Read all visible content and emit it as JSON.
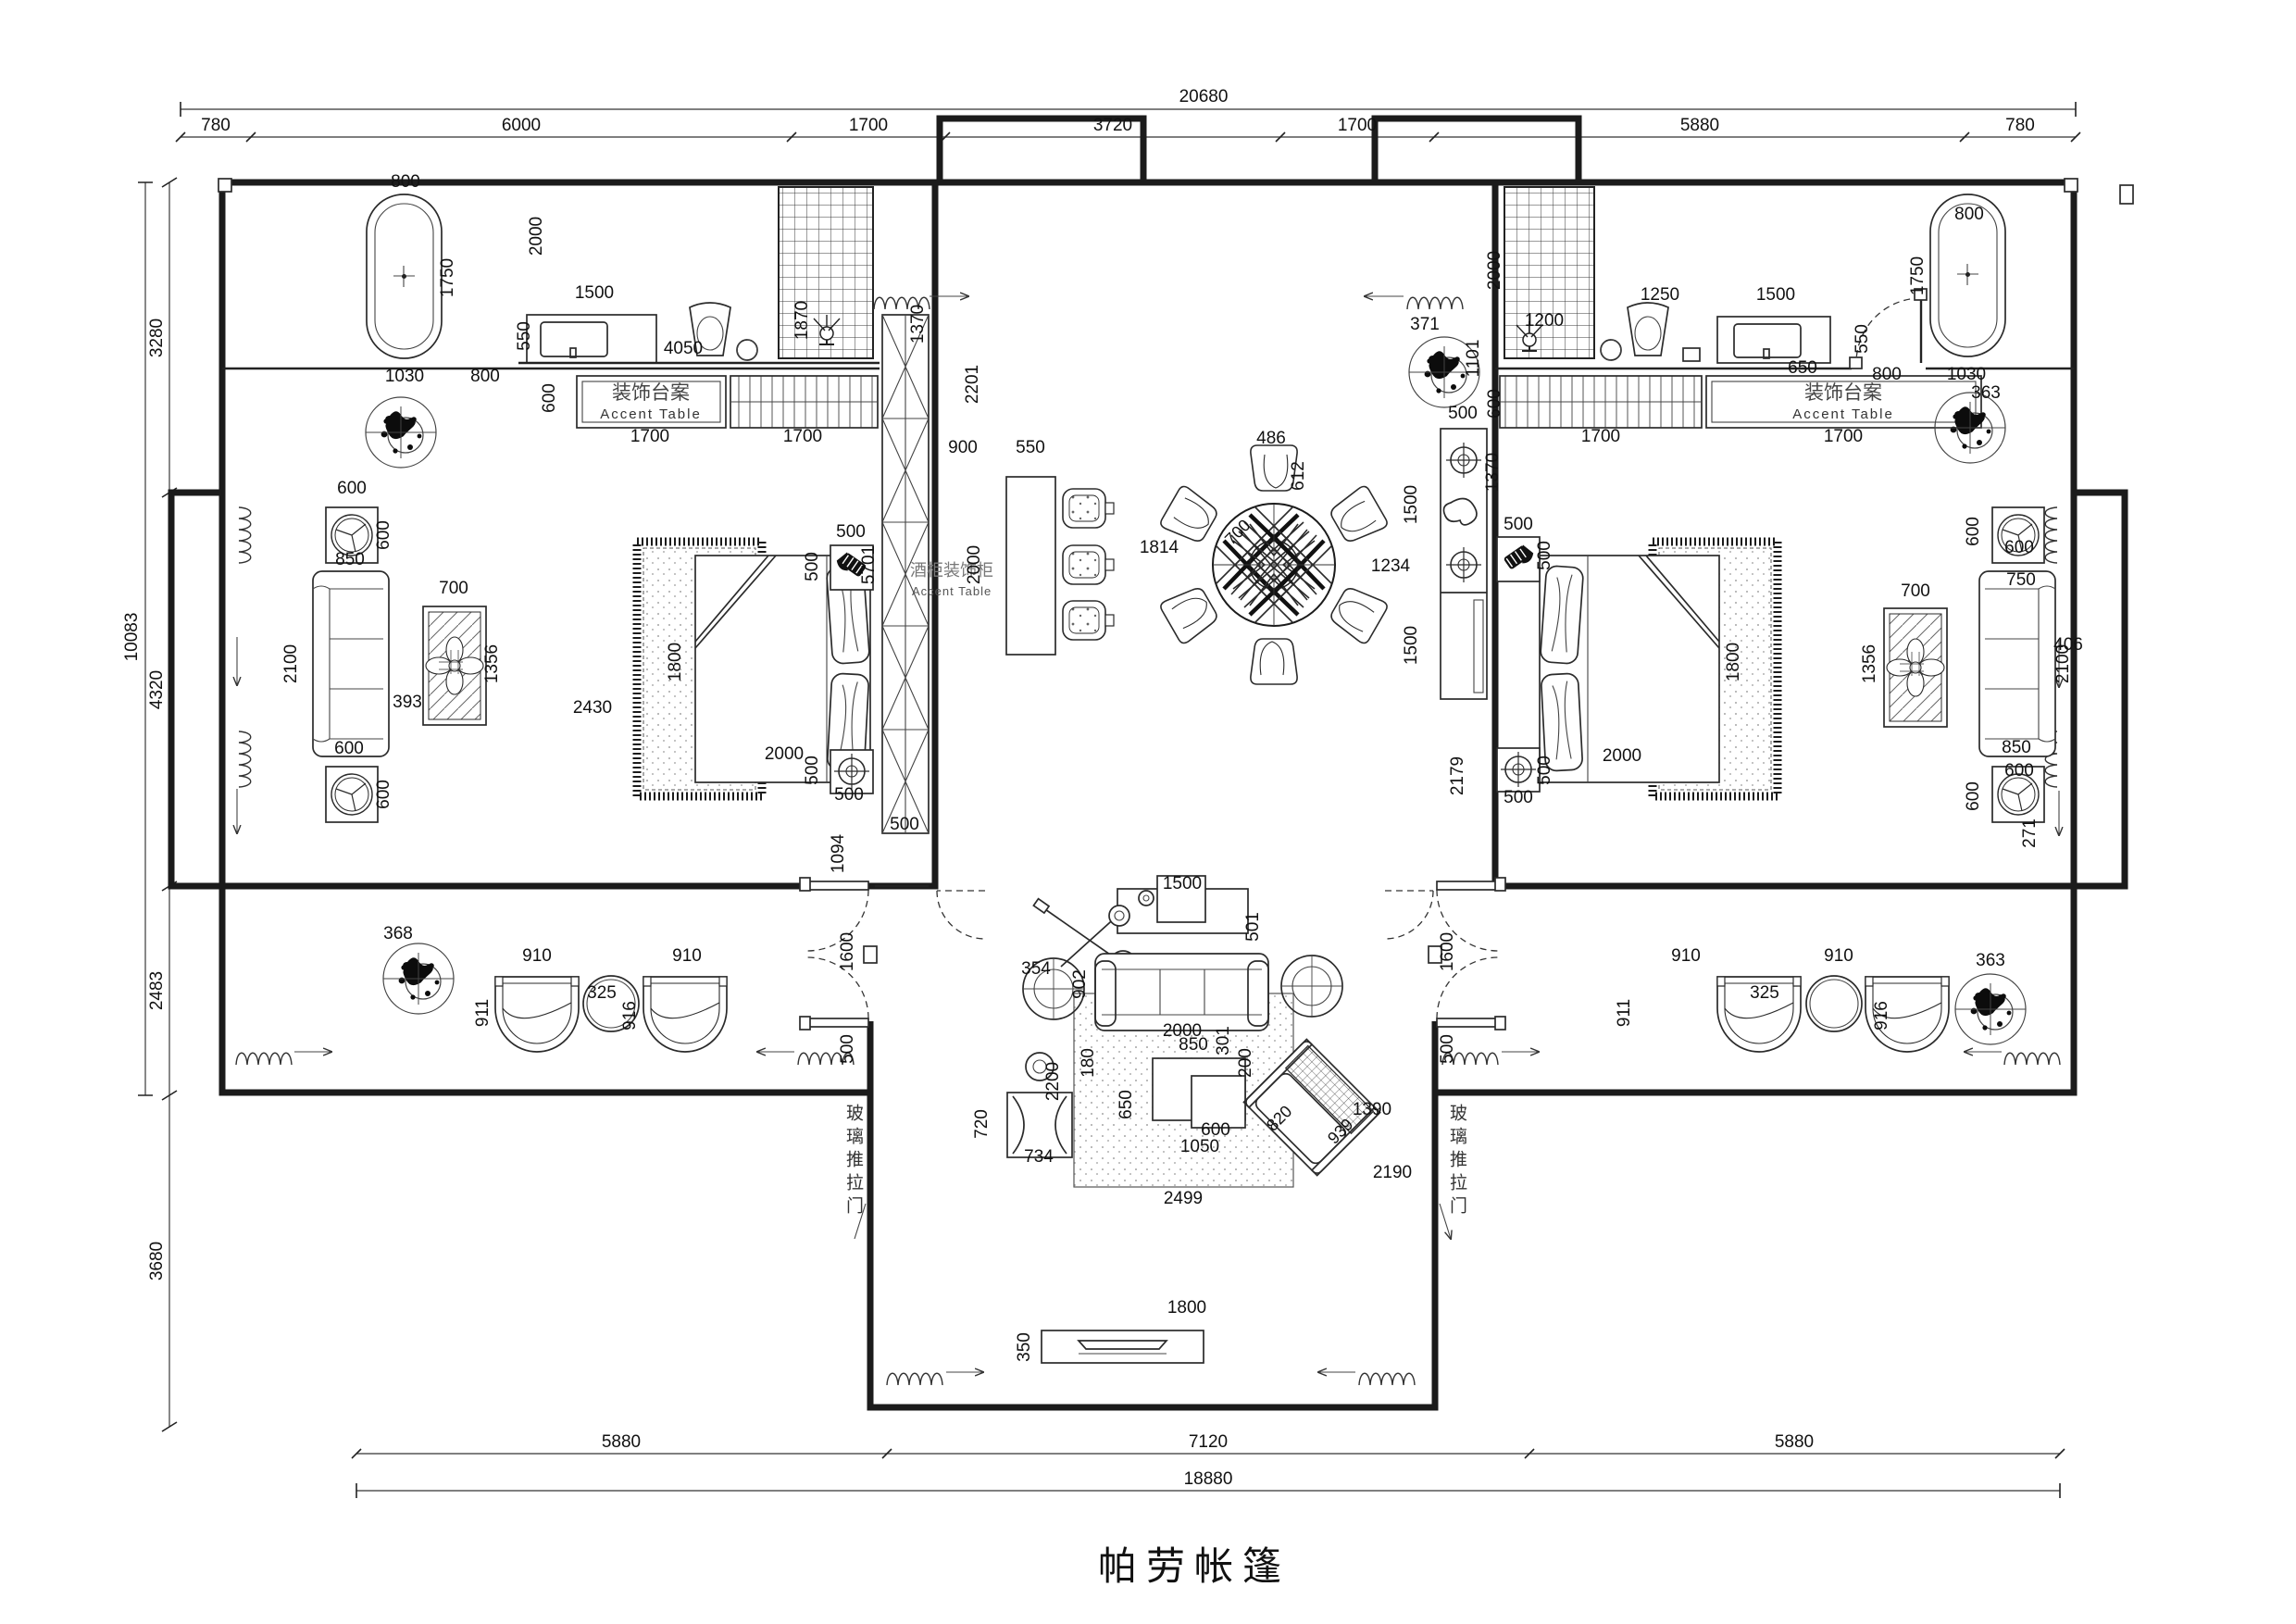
{
  "title": "帕劳帐篷",
  "labels": {
    "accent_cn": "装饰台案",
    "accent_en": "Accent Table",
    "cabinet_cn": "酒柜装饰柜",
    "cabinet_en": "Accent Table",
    "glass_door": "玻璃推拉门"
  },
  "dims": [
    [
      1300,
      110,
      "20680"
    ],
    [
      233,
      141,
      "780"
    ],
    [
      563,
      141,
      "6000"
    ],
    [
      938,
      141,
      "1700"
    ],
    [
      1202,
      141,
      "3720"
    ],
    [
      1466,
      141,
      "1700"
    ],
    [
      1836,
      141,
      "5880"
    ],
    [
      2182,
      141,
      "780"
    ],
    [
      148,
      688,
      "10083",
      -90
    ],
    [
      175,
      365,
      "3280",
      -90
    ],
    [
      175,
      745,
      "4320",
      -90
    ],
    [
      175,
      1070,
      "2483",
      -90
    ],
    [
      175,
      1362,
      "3680",
      -90
    ],
    [
      671,
      1563,
      "5880"
    ],
    [
      1305,
      1563,
      "7120"
    ],
    [
      1938,
      1563,
      "5880"
    ],
    [
      1305,
      1603,
      "18880"
    ],
    [
      438,
      202,
      "800"
    ],
    [
      489,
      300,
      "1750",
      -90
    ],
    [
      437,
      412,
      "1030"
    ],
    [
      524,
      412,
      "800"
    ],
    [
      642,
      322,
      "1500"
    ],
    [
      572,
      363,
      "550",
      -90
    ],
    [
      585,
      255,
      "2000",
      -90
    ],
    [
      738,
      382,
      "4050"
    ],
    [
      599,
      430,
      "600",
      -90
    ],
    [
      702,
      477,
      "1700"
    ],
    [
      867,
      477,
      "1700"
    ],
    [
      380,
      533,
      "600"
    ],
    [
      420,
      578,
      "600",
      -90
    ],
    [
      378,
      610,
      "850"
    ],
    [
      320,
      717,
      "2100",
      -90
    ],
    [
      377,
      814,
      "600"
    ],
    [
      420,
      858,
      "600",
      -90
    ],
    [
      490,
      641,
      "700"
    ],
    [
      537,
      717,
      "1356",
      -90
    ],
    [
      440,
      764,
      "393"
    ],
    [
      640,
      770,
      "2430"
    ],
    [
      735,
      715,
      "1800",
      -90
    ],
    [
      847,
      820,
      "2000"
    ],
    [
      919,
      580,
      "500"
    ],
    [
      883,
      612,
      "500",
      -90
    ],
    [
      917,
      864,
      "500"
    ],
    [
      883,
      832,
      "500",
      -90
    ],
    [
      911,
      922,
      "1094",
      -90
    ],
    [
      977,
      896,
      "500"
    ],
    [
      872,
      346,
      "1870",
      -90
    ],
    [
      997,
      350,
      "1370",
      -90
    ],
    [
      944,
      610,
      "5701",
      -90
    ],
    [
      1056,
      415,
      "2201",
      -90
    ],
    [
      1040,
      489,
      "900"
    ],
    [
      1113,
      489,
      "550"
    ],
    [
      1058,
      610,
      "2000",
      -90
    ],
    [
      1252,
      597,
      "1814"
    ],
    [
      1373,
      479,
      "486"
    ],
    [
      1408,
      514,
      "612",
      -90
    ],
    [
      1341,
      579,
      "700",
      -45
    ],
    [
      1502,
      617,
      "1234"
    ],
    [
      1580,
      452,
      "500"
    ],
    [
      1530,
      545,
      "1500",
      -90
    ],
    [
      1530,
      697,
      "1500",
      -90
    ],
    [
      1580,
      838,
      "2179",
      -90
    ],
    [
      1620,
      292,
      "2000",
      -90
    ],
    [
      1668,
      352,
      "1200"
    ],
    [
      1539,
      356,
      "371"
    ],
    [
      1597,
      387,
      "1101",
      -90
    ],
    [
      1793,
      324,
      "1250"
    ],
    [
      1918,
      324,
      "1500"
    ],
    [
      2017,
      366,
      "550",
      -90
    ],
    [
      1947,
      403,
      "650"
    ],
    [
      2038,
      410,
      "800"
    ],
    [
      2124,
      410,
      "1030"
    ],
    [
      2127,
      237,
      "800"
    ],
    [
      2077,
      298,
      "1750",
      -90
    ],
    [
      2145,
      430,
      "363"
    ],
    [
      1620,
      436,
      "600",
      -90
    ],
    [
      1729,
      477,
      "1700"
    ],
    [
      1991,
      477,
      "1700"
    ],
    [
      1640,
      572,
      "500"
    ],
    [
      1674,
      600,
      "500",
      -90
    ],
    [
      1640,
      867,
      "500"
    ],
    [
      1674,
      832,
      "500",
      -90
    ],
    [
      1618,
      510,
      "1370",
      -90
    ],
    [
      1752,
      822,
      "2000"
    ],
    [
      1878,
      715,
      "1800",
      -90
    ],
    [
      2183,
      632,
      "750"
    ],
    [
      2178,
      813,
      "850"
    ],
    [
      2137,
      574,
      "600",
      -90
    ],
    [
      2181,
      597,
      "600"
    ],
    [
      2181,
      838,
      "600"
    ],
    [
      2137,
      860,
      "600",
      -90
    ],
    [
      2069,
      644,
      "700"
    ],
    [
      2025,
      717,
      "1356",
      -90
    ],
    [
      2234,
      717,
      "2100",
      -90
    ],
    [
      2234,
      702,
      "406"
    ],
    [
      2198,
      900,
      "271",
      -90
    ],
    [
      580,
      1038,
      "910"
    ],
    [
      742,
      1038,
      "910"
    ],
    [
      650,
      1078,
      "325"
    ],
    [
      527,
      1094,
      "911",
      -90
    ],
    [
      686,
      1097,
      "916",
      -90
    ],
    [
      430,
      1014,
      "368"
    ],
    [
      1821,
      1038,
      "910"
    ],
    [
      1986,
      1038,
      "910"
    ],
    [
      1906,
      1078,
      "325"
    ],
    [
      1760,
      1094,
      "911",
      -90
    ],
    [
      2038,
      1097,
      "916",
      -90
    ],
    [
      2150,
      1043,
      "363"
    ],
    [
      921,
      1028,
      "1600",
      -90
    ],
    [
      921,
      1133,
      "500",
      -90
    ],
    [
      1569,
      1028,
      "1600",
      -90
    ],
    [
      1569,
      1133,
      "500",
      -90
    ],
    [
      1277,
      960,
      "1500"
    ],
    [
      1359,
      1001,
      "501",
      -90
    ],
    [
      1119,
      1052,
      "354"
    ],
    [
      1172,
      1063,
      "902",
      -90
    ],
    [
      1277,
      1119,
      "2000"
    ],
    [
      1289,
      1134,
      "850"
    ],
    [
      1327,
      1124,
      "301",
      -90
    ],
    [
      1351,
      1148,
      "200",
      -90
    ],
    [
      1181,
      1148,
      "180",
      -90
    ],
    [
      1222,
      1193,
      "650",
      -90
    ],
    [
      1313,
      1226,
      "600"
    ],
    [
      1296,
      1244,
      "1050"
    ],
    [
      1386,
      1212,
      "820",
      -45
    ],
    [
      1452,
      1226,
      "939",
      -45
    ],
    [
      1066,
      1214,
      "720",
      -90
    ],
    [
      1122,
      1255,
      "734"
    ],
    [
      1143,
      1168,
      "2200",
      -90
    ],
    [
      1278,
      1300,
      "2499"
    ],
    [
      1504,
      1272,
      "2190"
    ],
    [
      1482,
      1204,
      "1390"
    ],
    [
      1282,
      1418,
      "1800"
    ],
    [
      1112,
      1455,
      "350",
      -90
    ]
  ]
}
